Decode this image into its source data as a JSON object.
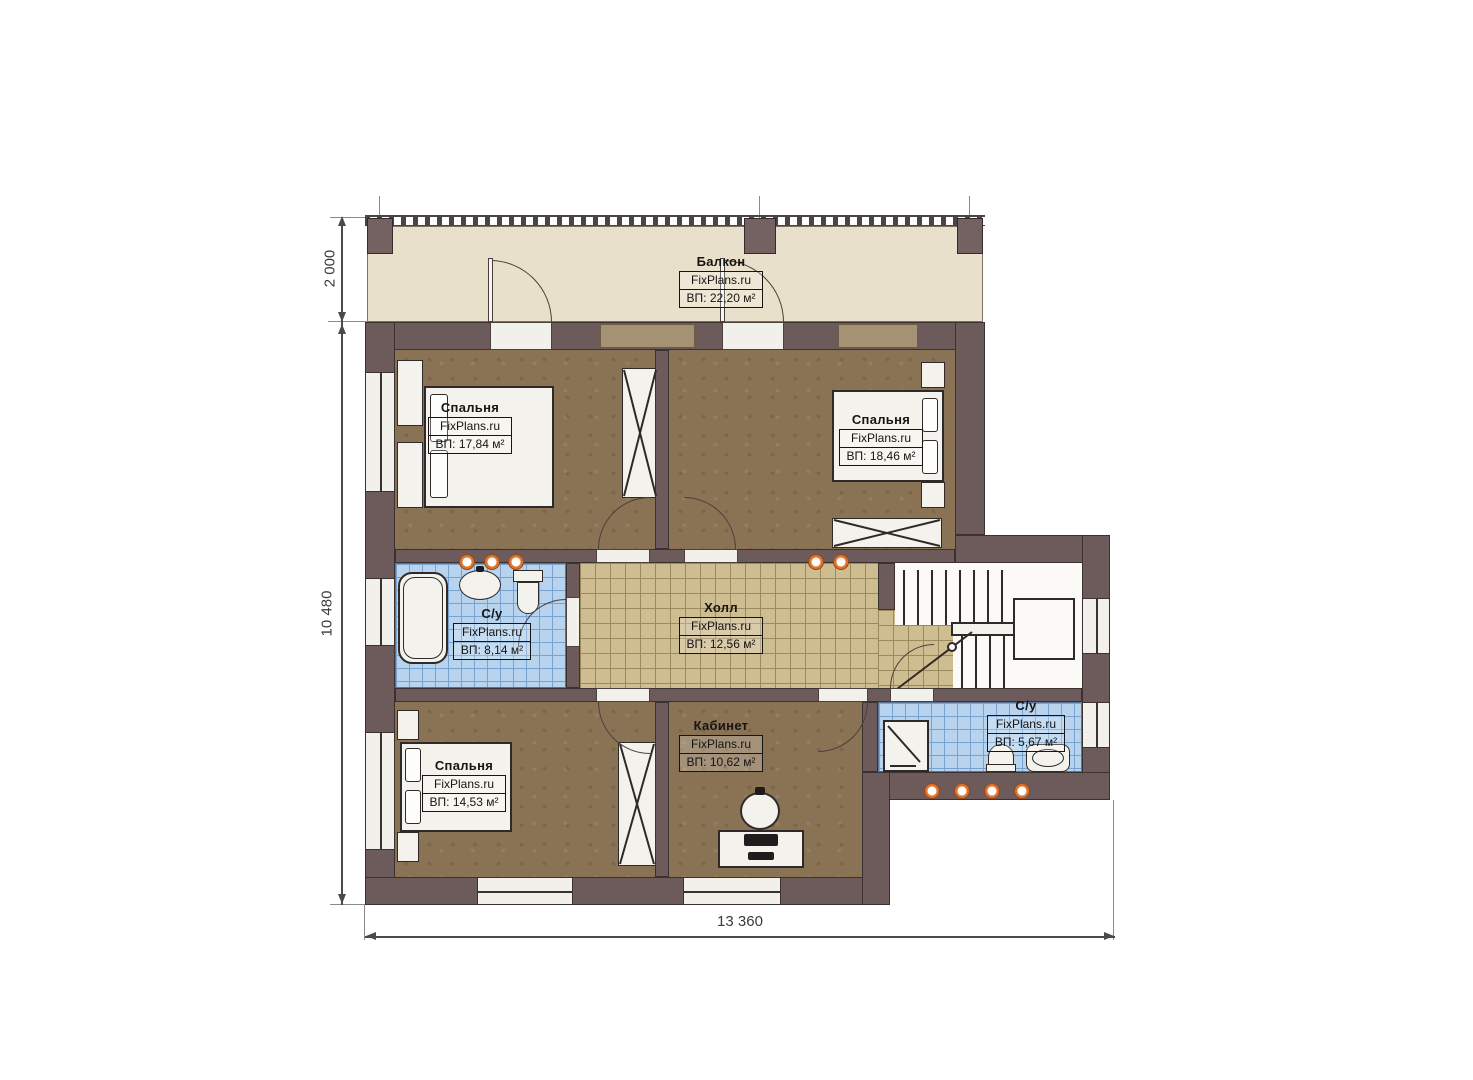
{
  "brand": "FixPlans.ru",
  "rooms": {
    "balcony": {
      "name": "Балкон",
      "area": "ВП: 22,20 м²"
    },
    "bedroom_top_left": {
      "name": "Спальня",
      "area": "ВП: 17,84 м²"
    },
    "bedroom_top_right": {
      "name": "Спальня",
      "area": "ВП: 18,46 м²"
    },
    "bathroom_left": {
      "name": "С/у",
      "area": "ВП: 8,14 м²"
    },
    "hall": {
      "name": "Холл",
      "area": "ВП: 12,56 м²"
    },
    "bathroom_right": {
      "name": "С/у",
      "area": "ВП: 5,67 м²"
    },
    "bedroom_bottom_left": {
      "name": "Спальня",
      "area": "ВП: 14,53 м²"
    },
    "office": {
      "name": "Кабинет",
      "area": "ВП: 10,62 м²"
    }
  },
  "dimensions": {
    "balcony_depth": "2 000",
    "left_height": "10 480",
    "bottom_width": "13 360"
  },
  "colors": {
    "wall": "#6d5b5b",
    "bedroom_floor": "#8a7254",
    "hall_floor": "#cfbd92",
    "bathroom_floor": "#b7d3ee",
    "balcony_floor": "#e9e0cb",
    "light_accent": "#e0722c"
  }
}
